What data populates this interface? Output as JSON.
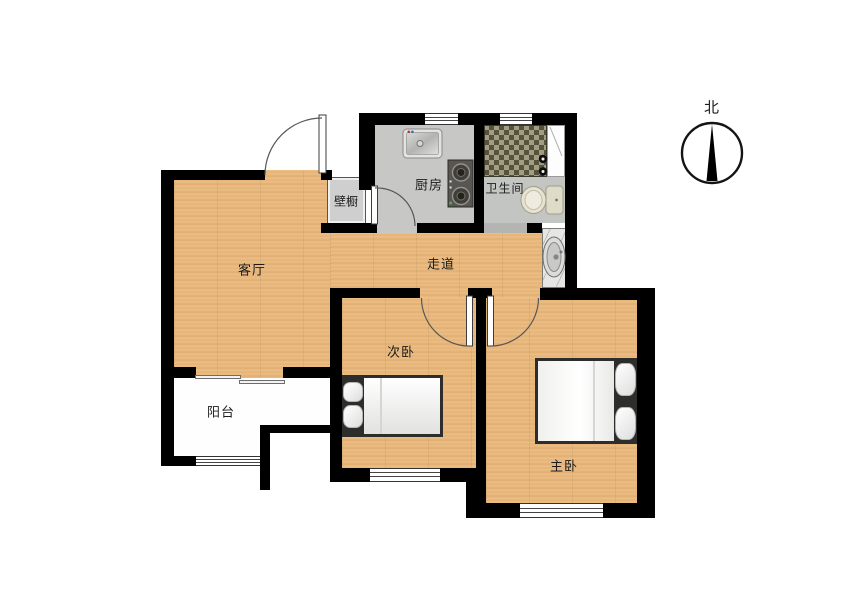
{
  "floor_plan": {
    "type": "apartment-floor-plan",
    "compass": {
      "north_label": "北"
    },
    "rooms": {
      "living": {
        "label": "客厅"
      },
      "kitchen": {
        "label": "厨房"
      },
      "bathroom": {
        "label": "卫生间"
      },
      "closet": {
        "label": "壁橱"
      },
      "hallway": {
        "label": "走道"
      },
      "second_bedroom": {
        "label": "次卧"
      },
      "master_bedroom": {
        "label": "主卧"
      },
      "balcony": {
        "label": "阳台"
      }
    },
    "fixtures": [
      "entrance-door",
      "kitchen-door",
      "kitchen-sink",
      "gas-stove",
      "shower-mosaic-area",
      "shower-knobs",
      "shower-screen",
      "toilet",
      "washbasin",
      "sliding-balcony-door",
      "single-bed",
      "double-bed",
      "second-bedroom-door",
      "master-bedroom-door",
      "north-compass"
    ],
    "windows_count": 5,
    "colors": {
      "wall": "#000000",
      "wood_floor": "#e7b87e",
      "kitchen_floor": "#c7c7c5",
      "bathroom_floor": "#c3c5c3",
      "balcony_floor": "#fefefe",
      "mosaic_dark": "#56523c",
      "mosaic_light": "#a19d82"
    }
  }
}
